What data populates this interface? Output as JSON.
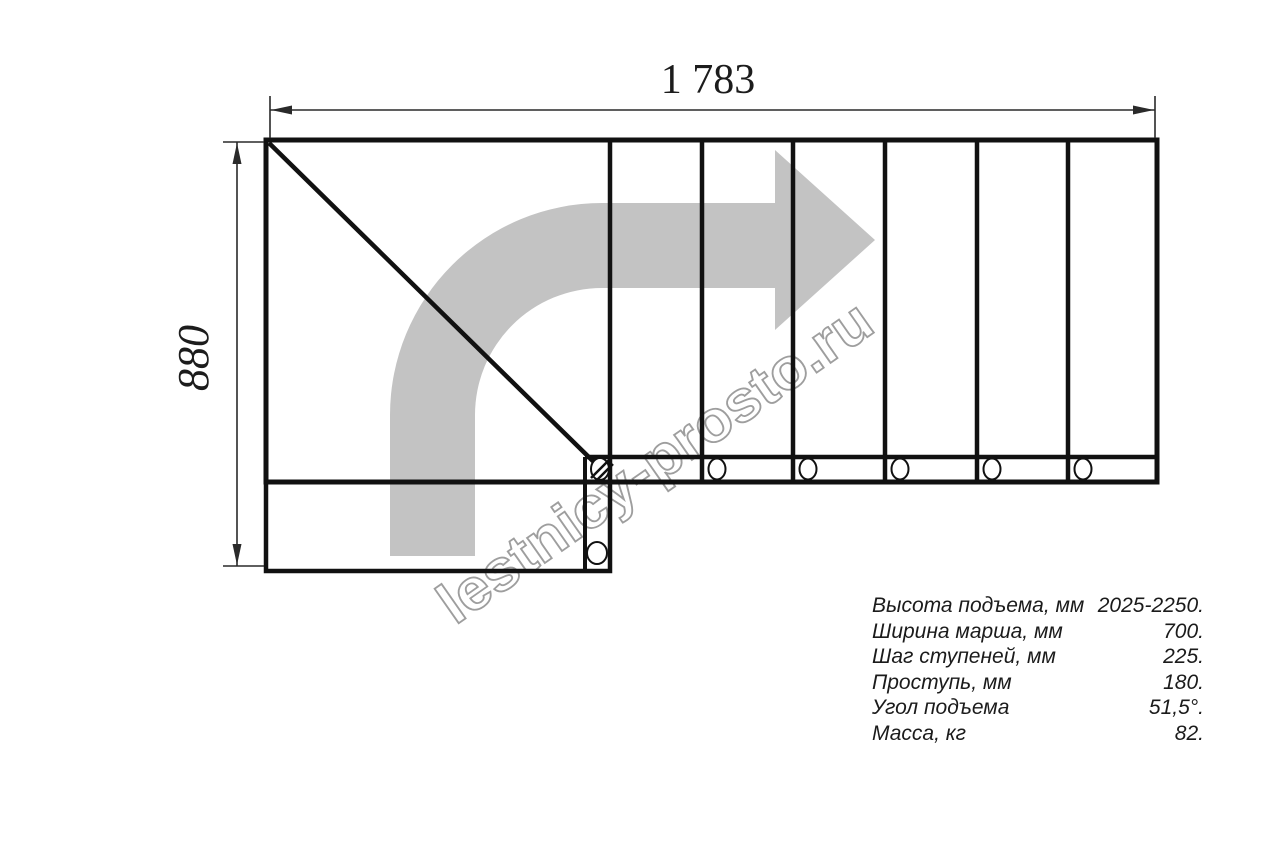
{
  "drawing": {
    "title_hint": "staircase-plan",
    "width_dimension": "1 783",
    "height_dimension": "880",
    "watermark": "lestnicy-prosto.ru"
  },
  "specs": {
    "rows": [
      {
        "label": "Высота подъема, мм",
        "value": "2025-2250."
      },
      {
        "label": "Ширина марша, мм",
        "value": "700."
      },
      {
        "label": "Шаг ступеней, мм",
        "value": "225."
      },
      {
        "label": "Проступь, мм",
        "value": "180."
      },
      {
        "label": "Угол подъема",
        "value": "51,5°."
      },
      {
        "label": "Масса, кг",
        "value": "82."
      }
    ]
  },
  "colors": {
    "line": "#111111",
    "dimension_line": "#2a2a2a",
    "arrow_gray": "#c3c3c3",
    "watermark_outline": "#9e9e9e",
    "text": "#1b1b1b",
    "background": "#ffffff"
  }
}
